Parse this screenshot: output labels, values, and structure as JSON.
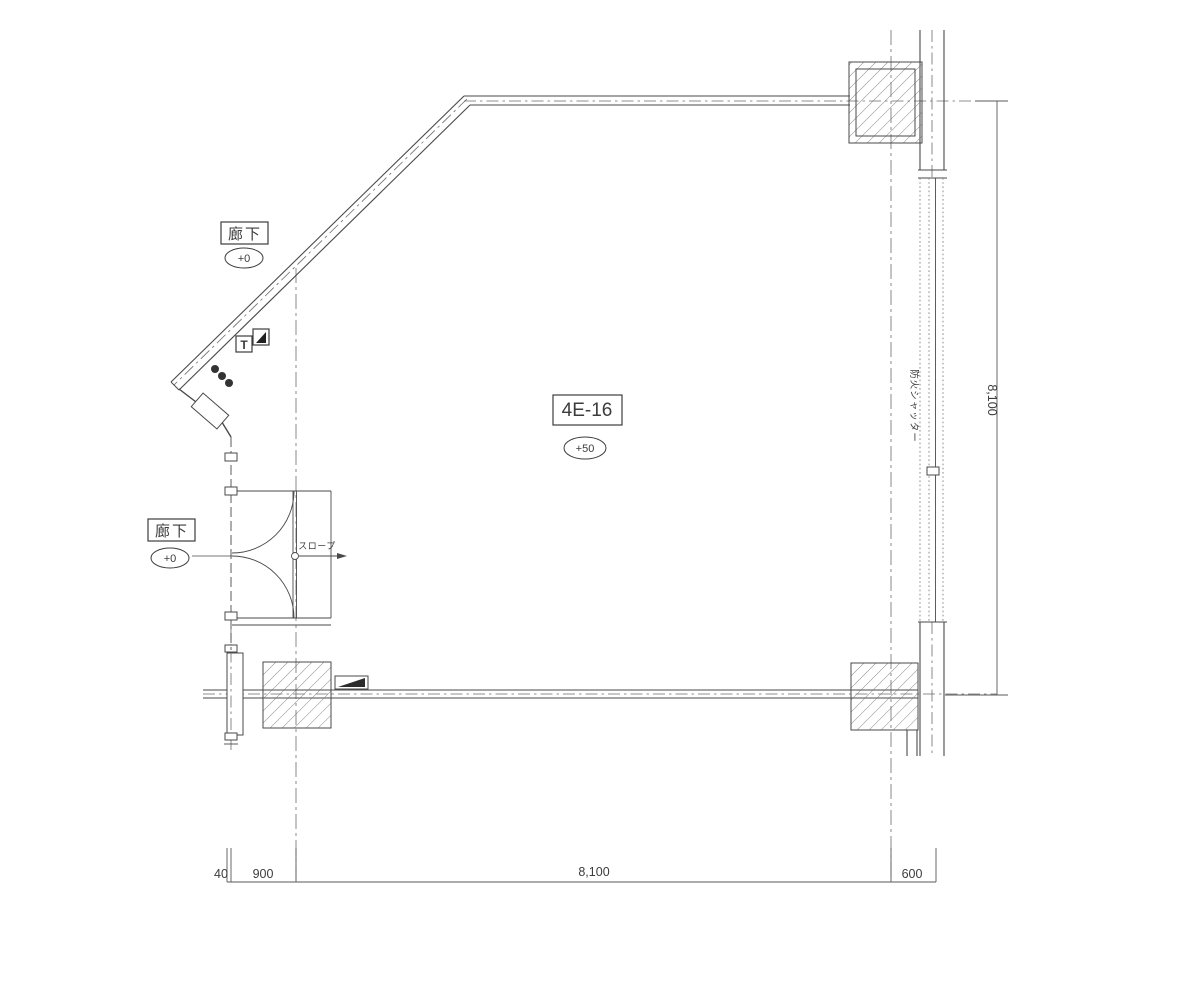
{
  "meta": {
    "drawing_type": "architectural-floor-plan"
  },
  "colors": {
    "line": "#4a4a4a",
    "hatch": "#707070",
    "centerline": "#6b6b6b",
    "text": "#3c3c3c",
    "background": "#ffffff"
  },
  "room": {
    "name": "4E-16",
    "level": "+50"
  },
  "corridors": {
    "top": {
      "name": "廊下",
      "level": "+0"
    },
    "left": {
      "name": "廊下",
      "level": "+0"
    }
  },
  "annotations": {
    "slope": "スロープ",
    "fire_shutter": "防火シャッター",
    "t_symbol": "T"
  },
  "dimensions": {
    "bottom": [
      "40",
      "900",
      "8,100",
      "600"
    ],
    "right": "8,100"
  }
}
